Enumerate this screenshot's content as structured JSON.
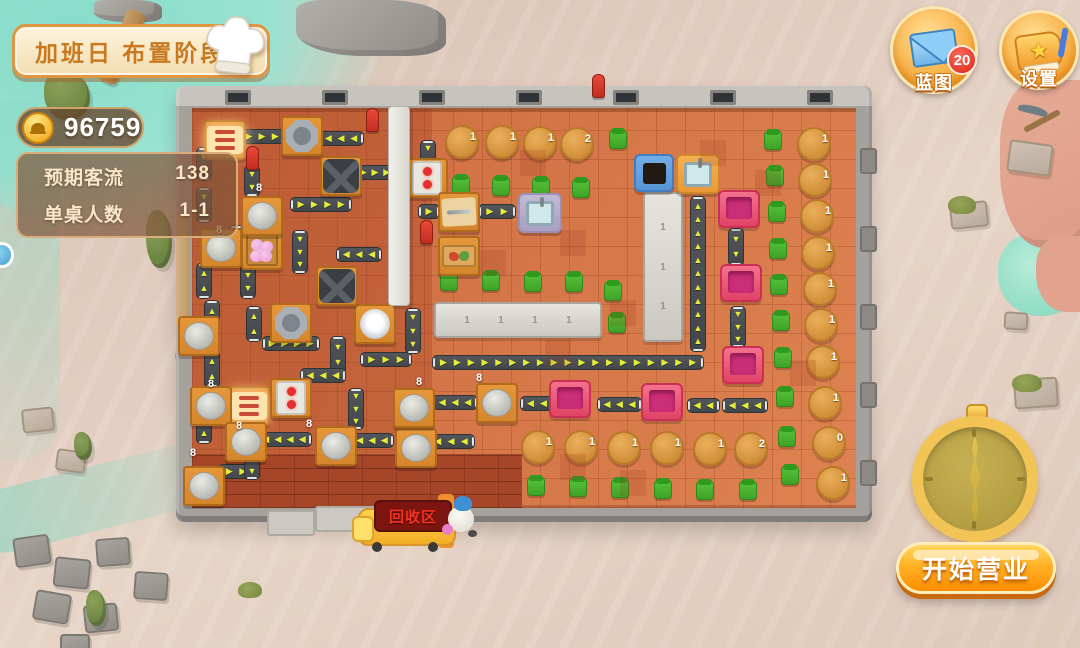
{
  "colors": {
    "sand": "#e0cbbd",
    "water": "#8fdcc8",
    "wall": "#a5a29d",
    "floor": "#d2744a",
    "floor_dark": "#a64629",
    "belt": "#4a4e53",
    "belt_arrow": "#e4ee39",
    "table_orange": "#dd8e2e",
    "dining_table": "#d99540",
    "pink_table": "#e84d73",
    "pink_inner": "#cb2e78",
    "chair_green": "#47b32e",
    "counter_gray": "#d8d6d0",
    "gold": "#f5b63c",
    "start_gradient_top": "#ffd95e",
    "start_gradient_bottom": "#ff8e00",
    "badge_red": "#dd2718",
    "sign_red": "#f53222"
  },
  "hud": {
    "stage_banner": "加班日 布置阶段",
    "coin_count": "96759",
    "stats": [
      {
        "label": "预期客流",
        "value": "138"
      },
      {
        "label": "单桌人数",
        "value": "1-1"
      }
    ],
    "blueprint_button": {
      "label": "蓝图",
      "badge": "20"
    },
    "settings_button": {
      "label": "设置"
    },
    "start_button": {
      "label": "开始营业"
    },
    "recycle_station": {
      "label": "回收区"
    }
  },
  "map": {
    "vents": [
      225,
      322,
      419,
      516,
      613,
      710,
      807
    ],
    "wall_pillars": [
      148,
      226,
      304,
      382,
      460
    ],
    "mats": [
      [
        267,
        510,
        48,
        26
      ],
      [
        315,
        506,
        128,
        26
      ]
    ],
    "belts": [
      [
        238,
        129,
        48,
        15,
        "r"
      ],
      [
        318,
        131,
        46,
        15,
        "l"
      ],
      [
        196,
        147,
        16,
        34,
        "d"
      ],
      [
        244,
        165,
        16,
        32,
        "d"
      ],
      [
        290,
        197,
        62,
        15,
        "r"
      ],
      [
        196,
        187,
        16,
        36,
        "d"
      ],
      [
        228,
        225,
        16,
        38,
        "d"
      ],
      [
        292,
        230,
        16,
        44,
        "d"
      ],
      [
        196,
        263,
        16,
        36,
        "u"
      ],
      [
        240,
        265,
        16,
        34,
        "d"
      ],
      [
        336,
        247,
        46,
        15,
        "l"
      ],
      [
        420,
        140,
        16,
        30,
        "d"
      ],
      [
        204,
        300,
        16,
        38,
        "u"
      ],
      [
        246,
        306,
        16,
        36,
        "u"
      ],
      [
        262,
        336,
        58,
        15,
        "r"
      ],
      [
        330,
        336,
        16,
        38,
        "d"
      ],
      [
        360,
        352,
        52,
        15,
        "r"
      ],
      [
        300,
        368,
        46,
        15,
        "l"
      ],
      [
        204,
        350,
        16,
        38,
        "u"
      ],
      [
        196,
        408,
        16,
        36,
        "u"
      ],
      [
        256,
        432,
        56,
        15,
        "l"
      ],
      [
        350,
        433,
        44,
        15,
        "l"
      ],
      [
        427,
        434,
        48,
        15,
        "l"
      ],
      [
        218,
        464,
        36,
        15,
        "r"
      ],
      [
        244,
        450,
        16,
        30,
        "d"
      ],
      [
        348,
        388,
        16,
        42,
        "d"
      ],
      [
        405,
        308,
        16,
        46,
        "d"
      ],
      [
        418,
        204,
        22,
        15,
        "r"
      ],
      [
        478,
        204,
        38,
        15,
        "r"
      ],
      [
        354,
        165,
        42,
        15,
        "r"
      ],
      [
        432,
        355,
        272,
        15,
        "r"
      ],
      [
        690,
        196,
        16,
        156,
        "u"
      ],
      [
        432,
        395,
        46,
        15,
        "l"
      ],
      [
        520,
        396,
        34,
        15,
        "l"
      ],
      [
        597,
        397,
        45,
        15,
        "l"
      ],
      [
        687,
        398,
        33,
        15,
        "l"
      ],
      [
        722,
        398,
        46,
        15,
        "l"
      ],
      [
        728,
        228,
        16,
        38,
        "d"
      ],
      [
        730,
        306,
        16,
        42,
        "d"
      ]
    ],
    "round_tables": [
      [
        445,
        125,
        "1"
      ],
      [
        485,
        125,
        "1"
      ],
      [
        523,
        126,
        "1"
      ],
      [
        560,
        127,
        "2"
      ],
      [
        797,
        127,
        "1"
      ],
      [
        798,
        163,
        "1"
      ],
      [
        800,
        199,
        "1"
      ],
      [
        801,
        236,
        "1"
      ],
      [
        803,
        272,
        "1"
      ],
      [
        804,
        308,
        "1"
      ],
      [
        806,
        345,
        "1"
      ],
      [
        808,
        386,
        "1"
      ],
      [
        812,
        426,
        "0"
      ],
      [
        816,
        466,
        "1"
      ],
      [
        521,
        430,
        "1"
      ],
      [
        564,
        430,
        "1"
      ],
      [
        607,
        431,
        "1"
      ],
      [
        650,
        431,
        "1"
      ],
      [
        693,
        432,
        "1"
      ],
      [
        734,
        432,
        "2"
      ]
    ],
    "pink_tables": [
      [
        718,
        190
      ],
      [
        720,
        264
      ],
      [
        722,
        346
      ],
      [
        549,
        380
      ],
      [
        641,
        383
      ]
    ],
    "counters": [
      {
        "x": 434,
        "y": 302,
        "w": 168,
        "h": 36,
        "marks": [
          "1",
          "1",
          "1",
          "1"
        ]
      },
      {
        "x": 643,
        "y": 192,
        "w": 40,
        "h": 150,
        "marks": [
          "1",
          "1",
          "1"
        ]
      }
    ],
    "chairs": [
      [
        452,
        176
      ],
      [
        492,
        177
      ],
      [
        532,
        178
      ],
      [
        572,
        179
      ],
      [
        609,
        130
      ],
      [
        440,
        272
      ],
      [
        482,
        272
      ],
      [
        524,
        273
      ],
      [
        565,
        273
      ],
      [
        604,
        282
      ],
      [
        608,
        314
      ],
      [
        764,
        131
      ],
      [
        766,
        167
      ],
      [
        768,
        203
      ],
      [
        769,
        240
      ],
      [
        770,
        276
      ],
      [
        772,
        312
      ],
      [
        774,
        349
      ],
      [
        776,
        388
      ],
      [
        778,
        428
      ],
      [
        781,
        466
      ],
      [
        527,
        477
      ],
      [
        569,
        478
      ],
      [
        611,
        479
      ],
      [
        654,
        480
      ],
      [
        696,
        481
      ],
      [
        739,
        481
      ]
    ],
    "equipment": [
      [
        "bread-display",
        204,
        120
      ],
      [
        "bread-display",
        228,
        386
      ],
      [
        "octagon-pot",
        281,
        116
      ],
      [
        "octagon-pot",
        270,
        303
      ],
      [
        "white-pot",
        354,
        304
      ],
      [
        "x-grill",
        320,
        156
      ],
      [
        "x-grill",
        316,
        266
      ],
      [
        "stove",
        406,
        158
      ],
      [
        "stove",
        270,
        378
      ],
      [
        "dumplings",
        241,
        230
      ],
      [
        "veg-crate",
        438,
        236
      ],
      [
        "knife-table",
        438,
        192
      ],
      [
        "red-item",
        246,
        146
      ],
      [
        "red-item",
        366,
        108
      ],
      [
        "red-item",
        592,
        74
      ],
      [
        "red-item",
        420,
        220
      ],
      [
        "sink",
        676,
        154
      ],
      [
        "sink-purple",
        518,
        193
      ],
      [
        "trash-bin",
        634,
        154
      ],
      [
        "pillar",
        388,
        106
      ],
      [
        "cylinder",
        241,
        196
      ],
      [
        "cylinder",
        200,
        228
      ],
      [
        "cylinder",
        178,
        316
      ],
      [
        "cylinder",
        190,
        386
      ],
      [
        "cylinder",
        225,
        422
      ],
      [
        "cylinder",
        315,
        426
      ],
      [
        "cylinder",
        395,
        428
      ],
      [
        "cylinder",
        183,
        466
      ],
      [
        "cylinder",
        476,
        383
      ],
      [
        "cylinder",
        393,
        388
      ]
    ],
    "loop_labels": [
      {
        "x": 256,
        "y": 182,
        "text": "8"
      },
      {
        "x": 216,
        "y": 224,
        "text": "8"
      },
      {
        "x": 208,
        "y": 378,
        "text": "8"
      },
      {
        "x": 236,
        "y": 420,
        "text": "8"
      },
      {
        "x": 306,
        "y": 418,
        "text": "8"
      },
      {
        "x": 416,
        "y": 376,
        "text": "8"
      },
      {
        "x": 190,
        "y": 447,
        "text": "8"
      },
      {
        "x": 476,
        "y": 372,
        "text": "8"
      }
    ]
  },
  "decorations": [
    [
      "slab",
      14,
      536,
      36,
      30,
      -8
    ],
    [
      "slab",
      54,
      558,
      36,
      30,
      6
    ],
    [
      "slab",
      96,
      538,
      34,
      28,
      -4
    ],
    [
      "slab",
      34,
      592,
      36,
      30,
      10
    ],
    [
      "slab",
      84,
      604,
      34,
      28,
      -6
    ],
    [
      "slab",
      134,
      572,
      34,
      28,
      4
    ],
    [
      "slab",
      60,
      634,
      30,
      24,
      0
    ],
    [
      "slab-tan",
      1008,
      142,
      44,
      32,
      8
    ],
    [
      "slab-tan",
      950,
      202,
      38,
      26,
      -6
    ],
    [
      "slab-tan",
      1004,
      312,
      24,
      18,
      4
    ],
    [
      "slab-tan",
      1014,
      378,
      44,
      30,
      -4
    ],
    [
      "slab-tan",
      176,
      340,
      30,
      22,
      6
    ],
    [
      "slab-tan",
      22,
      408,
      32,
      24,
      -6
    ],
    [
      "slab-tan",
      56,
      450,
      30,
      22,
      8
    ],
    [
      "cactus",
      44,
      70,
      46,
      50,
      0
    ],
    [
      "cactus",
      146,
      210,
      26,
      58,
      0
    ],
    [
      "cactus",
      74,
      432,
      18,
      28,
      0
    ],
    [
      "cactus",
      86,
      590,
      20,
      36,
      0
    ],
    [
      "grass",
      238,
      582,
      24,
      16,
      0
    ],
    [
      "grass",
      948,
      196,
      28,
      18,
      0
    ],
    [
      "grass",
      1012,
      374,
      30,
      18,
      0
    ],
    [
      "rock",
      296,
      0,
      150,
      56,
      0
    ],
    [
      "rock",
      94,
      0,
      68,
      22,
      0
    ],
    [
      "plank",
      112,
      8,
      20,
      78,
      24
    ],
    [
      "pickaxe",
      1018,
      104,
      46,
      34,
      0
    ],
    [
      "blue-marker",
      -10,
      242,
      24,
      26,
      0
    ]
  ]
}
